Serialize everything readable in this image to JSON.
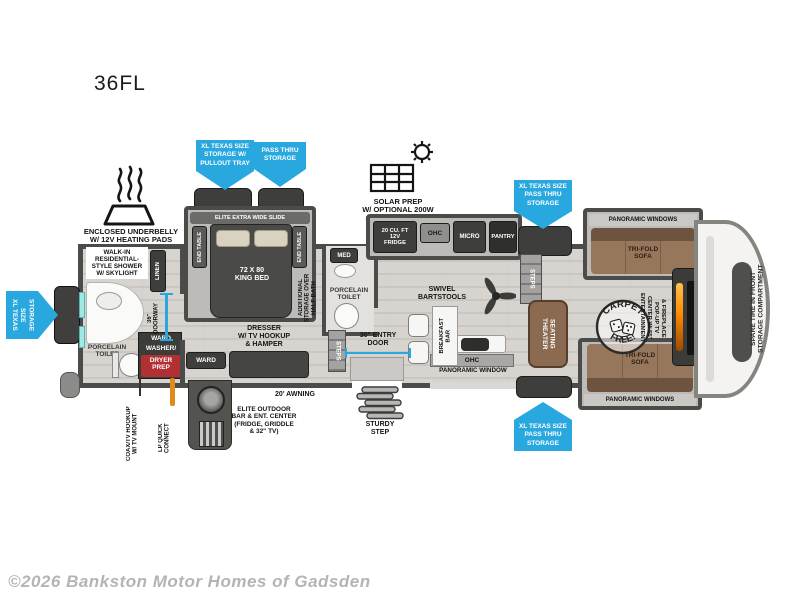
{
  "title": "36FL",
  "copyright": "©2026 Bankston Motor Homes of Gadsden",
  "colors": {
    "callout_blue": "#29a8e0",
    "washer_red": "#b13032",
    "fireplace_orange": "#ff8a00",
    "sofa_brown": "#97775b",
    "window_teal": "#9fe8e4"
  },
  "callouts": {
    "storage_pullout": "XL TEXAS SIZE\nSTORAGE W/\nPULLOUT TRAY",
    "pass_thru": "PASS THRU\nSTORAGE",
    "xl_pass_thru_top": "XL TEXAS SIZE\nPASS THRU\nSTORAGE",
    "xl_pass_thru_bottom": "XL TEXAS SIZE\nPASS THRU\nSTORAGE",
    "xl_storage_rear": "XL TEXAS SIZE\nSTORAGE"
  },
  "exterior": {
    "underbelly": "ENCLOSED UNDERBELLY\nW/ 12V HEATING PADS",
    "solar": "SOLAR PREP\nW/ OPTIONAL 200W\nSOLAR PACKAGE",
    "awning": "20' AWNING",
    "outdoor_kitchen": "ELITE OUTDOOR\nBAR & ENT. CENTER\n(FRIDGE, GRIDDLE\n& 32\" TV)",
    "coax": "COAX/TV HOOKUP\nW/ TV MOUNT",
    "lp": "LP QUICK\nCONNECT",
    "entry_door": "30\" ENTRY\nDOOR",
    "sturdy_step": "STURDY\nSTEP",
    "spare_tire": "SPARE TIRE IN FRONT\nSTORAGE COMPARTMENT"
  },
  "bedroom": {
    "slide": "ELITE EXTRA WIDE SLIDE",
    "end_table": "END TABLE",
    "bed": "72 X 80\nKING BED",
    "dresser": "DRESSER\nW/ TV HOOKUP\n& HAMPER",
    "ward": "WARD"
  },
  "bathroom": {
    "shower": "WALK-IN\nRESIDENTIAL-\nSTYLE SHOWER\nW/ SKYLIGHT",
    "linen": "LINEN",
    "doorway": "36\"\nDOORWAY",
    "toilet": "PORCELAIN\nTOILET",
    "ward": "WARD",
    "washer_prefix": "WASHER/",
    "washer_red_label": "DRYER\nPREP"
  },
  "half_bath": {
    "med": "MED",
    "storage": "ADDITIONAL\nSTORAGE OVER\nHALF BATH",
    "toilet": "PORCELAIN\nTOILET",
    "steps": "STEPS"
  },
  "kitchen": {
    "fridge": "20 CU. FT\n12V\nFRIDGE",
    "ohc": "OHC",
    "micro": "MICRO",
    "pantry": "PANTRY",
    "island_ohc": "OHC",
    "window": "PANORAMIC WINDOW",
    "steps": "STEPS",
    "barstools": "SWIVEL\nBARTSTOOLS",
    "breakfast_bar": "BREAKFAST\nBAR"
  },
  "living": {
    "theater": "THEATER\nSEATING",
    "sofa": "TRI-FOLD\nSOFA",
    "windows": "PANORAMIC WINDOWS",
    "entertainment": "ENTERTAINMENT\nCENTER W/ 55\"\nPOP-UP TV\n& FIREPLACE",
    "carpet_arc_top": "CARPET",
    "carpet_arc_bottom": "FREE!"
  }
}
